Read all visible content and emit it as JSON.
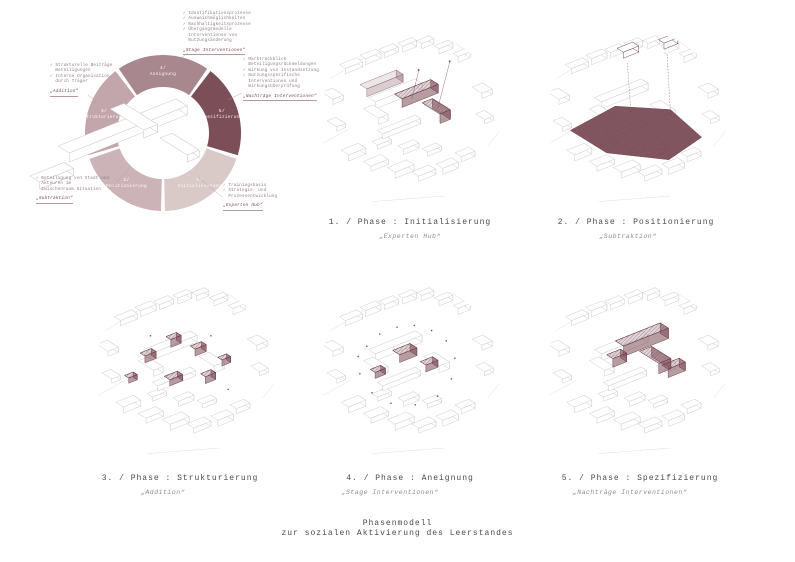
{
  "poster": {
    "footer_line1": "Phasenmodell",
    "footer_line2": "zur sozialen Aktivierung des Leerstandes"
  },
  "colors": {
    "maroon": "#7b4b55",
    "maroon_dark": "#6e3f4a",
    "maroon_plane": "#71404a",
    "line_gray": "#c4c4c4",
    "text_gray": "#4a4a4a"
  },
  "ring": {
    "segments": [
      {
        "num": "1/",
        "label": "Initialisierung",
        "color": "#d9c9c7"
      },
      {
        "num": "2/",
        "label": "Positionierung",
        "color": "#ccb3b8"
      },
      {
        "num": "3/",
        "label": "Strukturierung",
        "color": "#c2a6ac"
      },
      {
        "num": "4/",
        "label": "Aneignung",
        "color": "#a8878f"
      },
      {
        "num": "5/",
        "label": "Spezifizierung",
        "color": "#7c4e58"
      }
    ],
    "callouts": [
      {
        "id": "initialisierung",
        "lines": [
          "✓ Trainingsbasis",
          "✓ Strategie- und",
          "  Prozessentwicklung"
        ],
        "quote": "„Experten Hub“"
      },
      {
        "id": "positionierung",
        "lines": [
          "✓ Beteiligung von Stadt und",
          "  Akteuren im",
          "  Zwischenraum Situation"
        ],
        "quote": "„Subtraktion“"
      },
      {
        "id": "strukturierung",
        "lines": [
          "✓ Strukturelle Beiträge",
          "  Beteiligungen",
          "✓ Interne Organisation",
          "  durch Träger"
        ],
        "quote": "„Addition“"
      },
      {
        "id": "aneignung",
        "lines": [
          "✓ Identifikationsprozesse",
          "✓ Ausweichmöglichkeiten",
          "✓ Nachhaltigkeitsprozesse",
          "✓ Übergangsmodelle",
          "  Interventionen von",
          "  Nutzungsänderung"
        ],
        "quote": "„Stage Interventionen“"
      },
      {
        "id": "spezifizierung",
        "lines": [
          "✓ Marktrückblick",
          "  Beteiligungsrückmeldungen",
          "✓ Wirkung von Instandsetzung",
          "✓ Nutzungsspezifische",
          "  Interventionen und",
          "  Wirkungsüberprüfung"
        ],
        "quote": "„Nachträge Interventionen“"
      }
    ]
  },
  "panels": [
    {
      "caption": "1. / Phase : Initialisierung",
      "subtitle": "„Experten Hub“"
    },
    {
      "caption": "2. / Phase : Positionierung",
      "subtitle": "„Subtraktion“"
    },
    {
      "caption": "3. / Phase : Strukturierung",
      "subtitle": "„Addition“"
    },
    {
      "caption": "4. / Phase : Aneignung",
      "subtitle": "„Stage Interventionen“"
    },
    {
      "caption": "5. / Phase : Spezifizierung",
      "subtitle": "„Nachträge Interventionen“"
    }
  ]
}
